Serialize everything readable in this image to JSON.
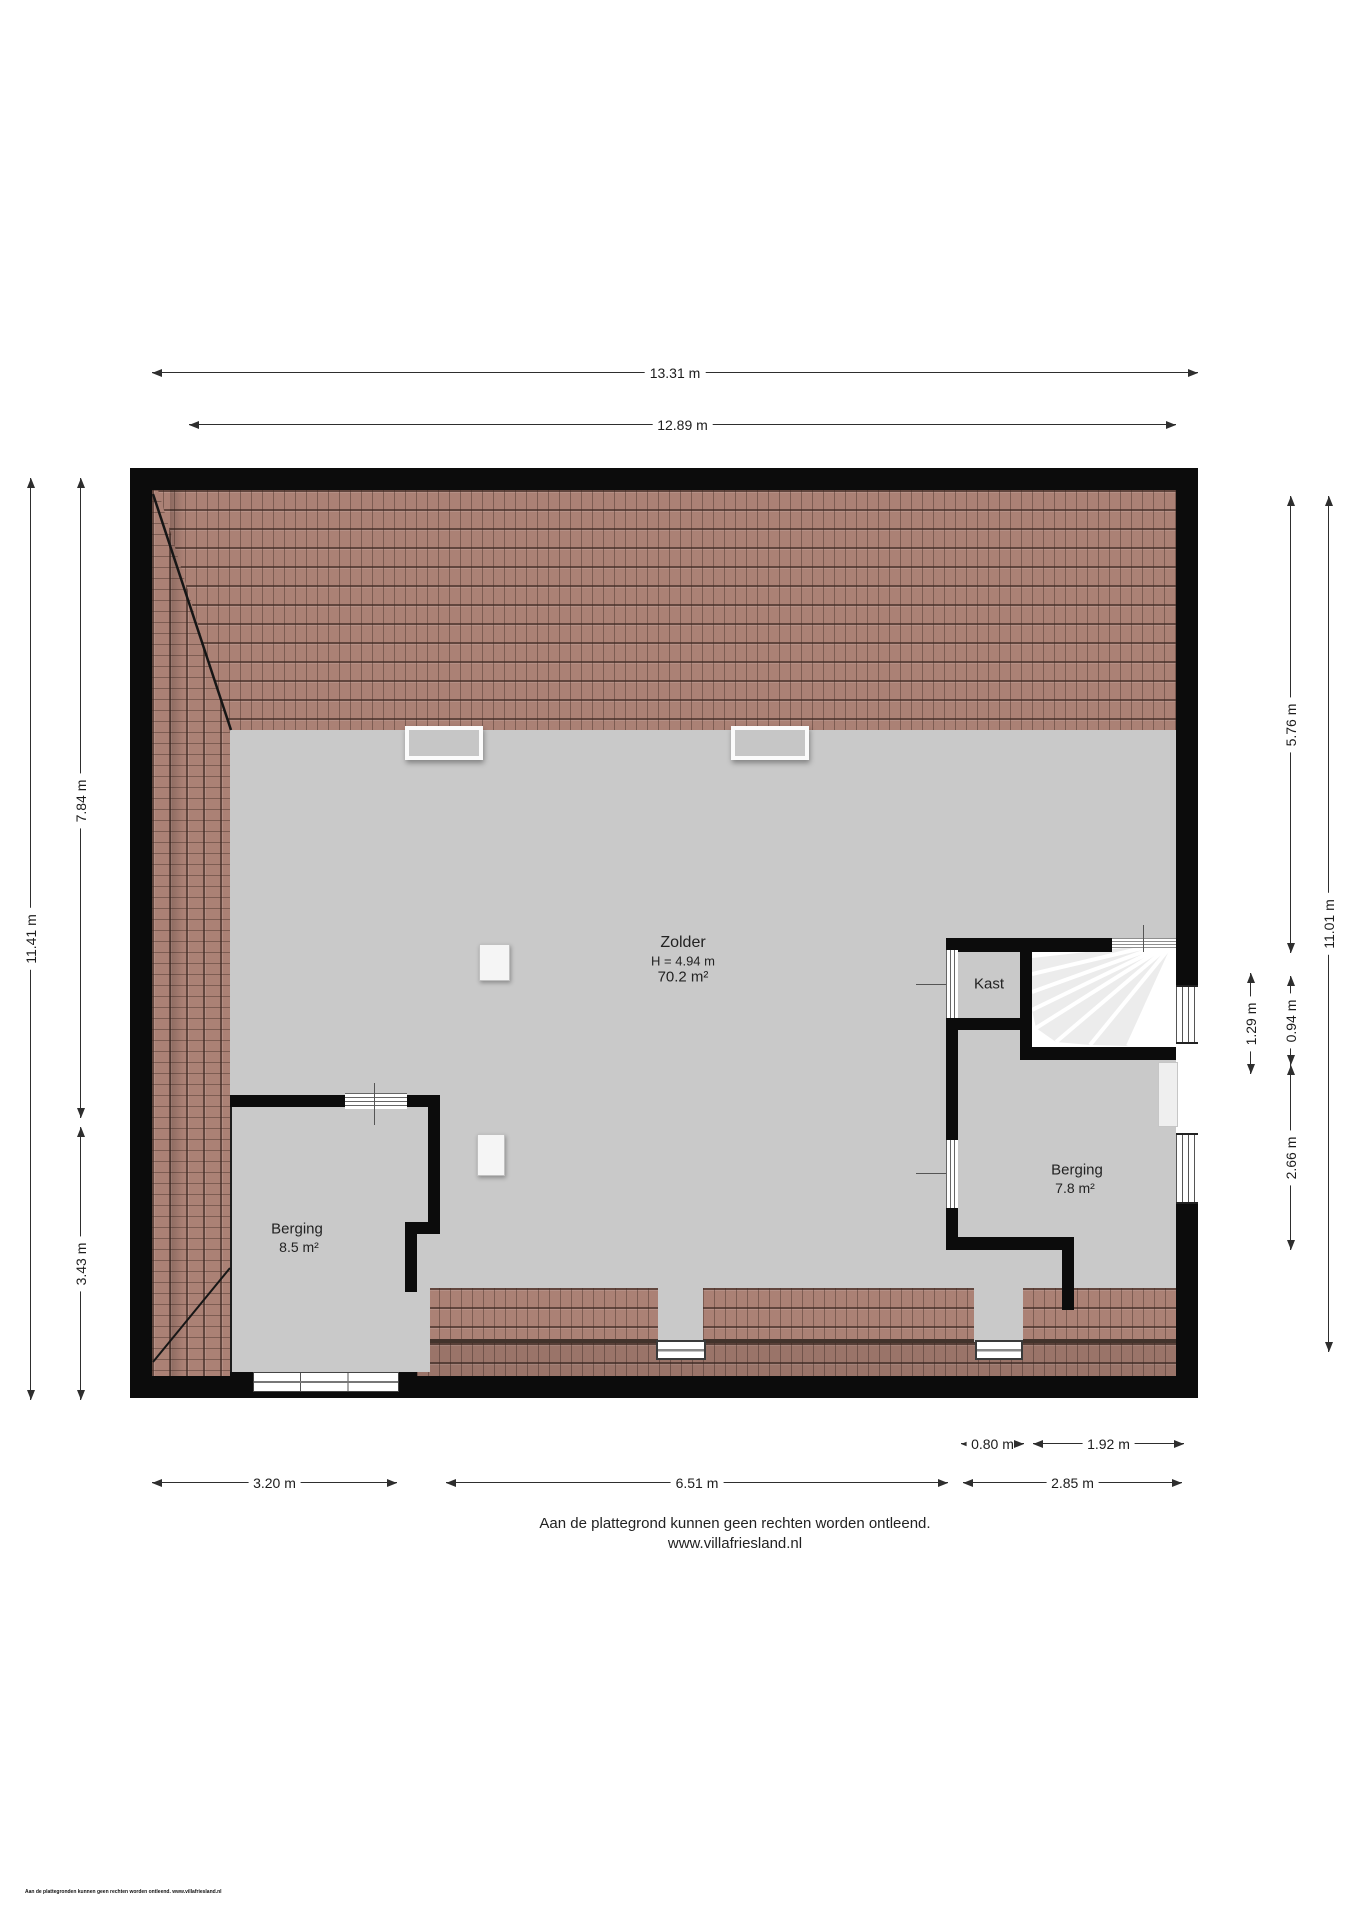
{
  "dims": {
    "top": [
      "13.31 m",
      "12.89 m"
    ],
    "left": [
      "11.41 m",
      "7.84 m",
      "3.43 m"
    ],
    "right": [
      "5.76 m",
      "11.01 m",
      "1.29 m",
      "0.94 m",
      "2.66 m"
    ],
    "bottom": [
      "0.80 m",
      "1.92 m",
      "3.20 m",
      "6.51 m",
      "2.85 m"
    ]
  },
  "rooms": {
    "zolder": {
      "name": "Zolder",
      "height": "H = 4.94 m",
      "area": "70.2 m²"
    },
    "kast": {
      "name": "Kast"
    },
    "berging_right": {
      "name": "Berging",
      "area": "7.8 m²"
    },
    "berging_left": {
      "name": "Berging",
      "area": "8.5 m²"
    }
  },
  "footer": {
    "disclaimer": "Aan de plattegrond kunnen geen rechten worden ontleend.",
    "website": "www.villafriesland.nl",
    "small_print": "Aan de plattegronden kunnen geen rechten worden ontleend. www.villafriesland.nl"
  },
  "colors": {
    "wall": "#0c0c0c",
    "floor": "#c9c9c9",
    "roof_tile": "#ab8175",
    "dimension_line": "#2e2e2e"
  }
}
